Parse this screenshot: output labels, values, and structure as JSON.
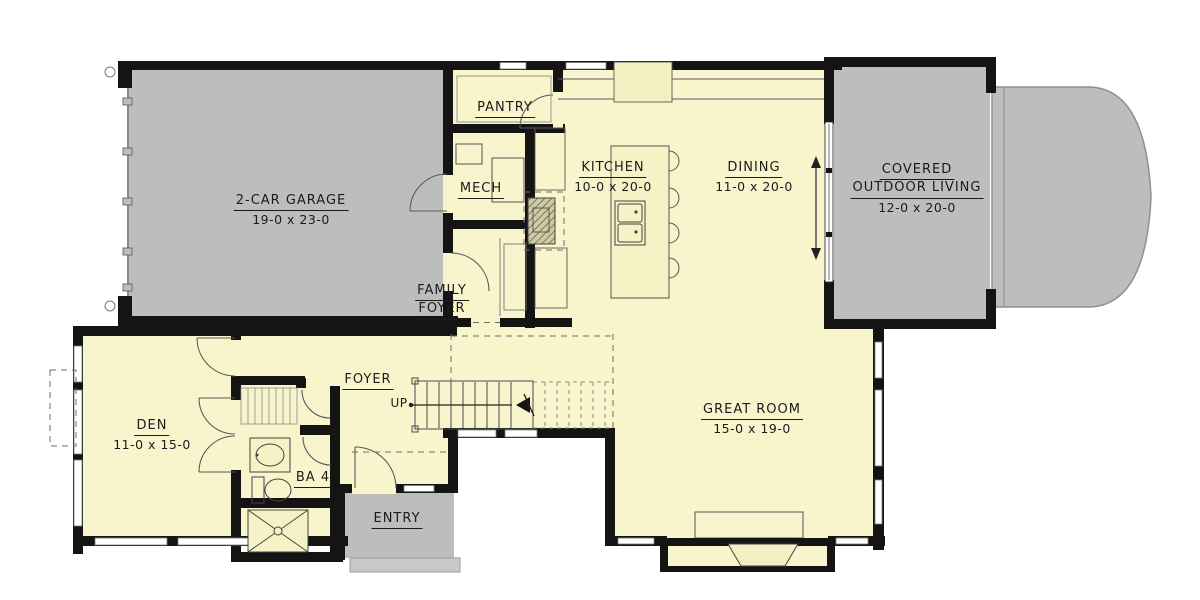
{
  "plan": {
    "type": "architectural-floor-plan",
    "colors": {
      "floor": "#f8f4cc",
      "porch_gray": "#bdbdbd",
      "wall_black": "#141414",
      "line": "#555555",
      "background": "#ffffff"
    },
    "rooms": {
      "garage": {
        "name": "2-CAR GARAGE",
        "dims": "19-0 x 23-0"
      },
      "pantry": {
        "name": "PANTRY"
      },
      "mech": {
        "name": "MECH"
      },
      "kitchen": {
        "name": "KITCHEN",
        "dims": "10-0 x 20-0"
      },
      "dining": {
        "name": "DINING",
        "dims": "11-0 x 20-0"
      },
      "outdoor": {
        "line1": "COVERED",
        "line2": "OUTDOOR LIVING",
        "dims": "12-0 x 20-0"
      },
      "family_foyer": {
        "line1": "FAMILY",
        "line2": "FOYER"
      },
      "foyer": {
        "name": "FOYER"
      },
      "stairs": {
        "label": "UP"
      },
      "den": {
        "name": "DEN",
        "dims": "11-0 x 15-0"
      },
      "ba4": {
        "name": "BA 4"
      },
      "entry": {
        "name": "ENTRY"
      },
      "great_room": {
        "name": "GREAT ROOM",
        "dims": "15-0 x 19-0"
      }
    }
  }
}
